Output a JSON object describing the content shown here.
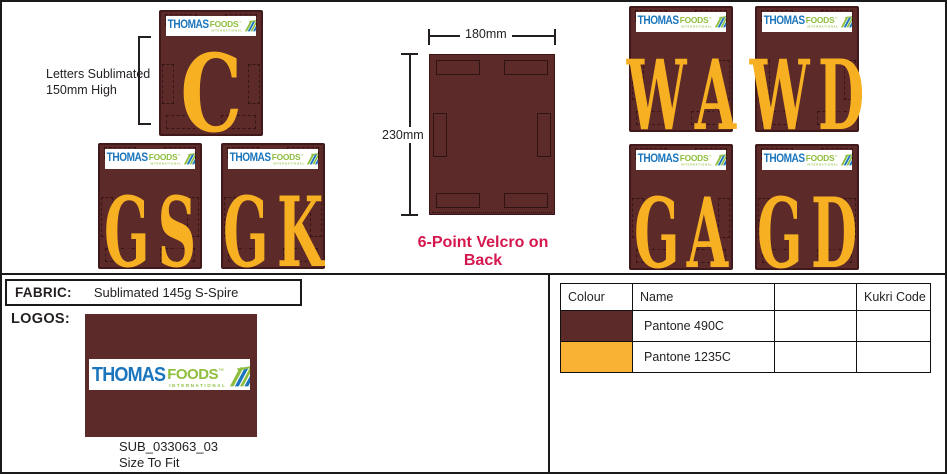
{
  "colors": {
    "maroon": "#5C2A29",
    "gold": "#F8B023",
    "logo_blue": "#1B75BC",
    "logo_green": "#8FBE3F",
    "velcro_note_red": "#D5174E"
  },
  "notes": {
    "letters_line1": "Letters Sublimated",
    "letters_line2": "150mm High",
    "width_label": "180mm",
    "height_label": "230mm",
    "velcro": "6-Point Velcro on Back"
  },
  "patches": [
    {
      "letters": "C"
    },
    {
      "letters": "GS"
    },
    {
      "letters": "GK"
    },
    {
      "letters": "WA"
    },
    {
      "letters": "WD"
    },
    {
      "letters": "GA"
    },
    {
      "letters": "GD"
    }
  ],
  "logo": {
    "thomas": "THOMAS",
    "foods": "FOODS",
    "tm": "™",
    "international": "INTERNATIONAL"
  },
  "fabric": {
    "label": "FABRIC:",
    "value": "Sublimated 145g S-Spire"
  },
  "logos_section": {
    "label": "LOGOS:",
    "code": "SUB_033063_03",
    "fit": "Size To Fit"
  },
  "colour_table": {
    "headers": [
      "Colour",
      "Name",
      "",
      "Kukri Code"
    ],
    "rows": [
      {
        "colour_hex": "#5C2A29",
        "name": "Pantone 490C",
        "kukri_code": ""
      },
      {
        "colour_hex": "#F9B233",
        "name": "Pantone 1235C",
        "kukri_code": ""
      }
    ]
  }
}
